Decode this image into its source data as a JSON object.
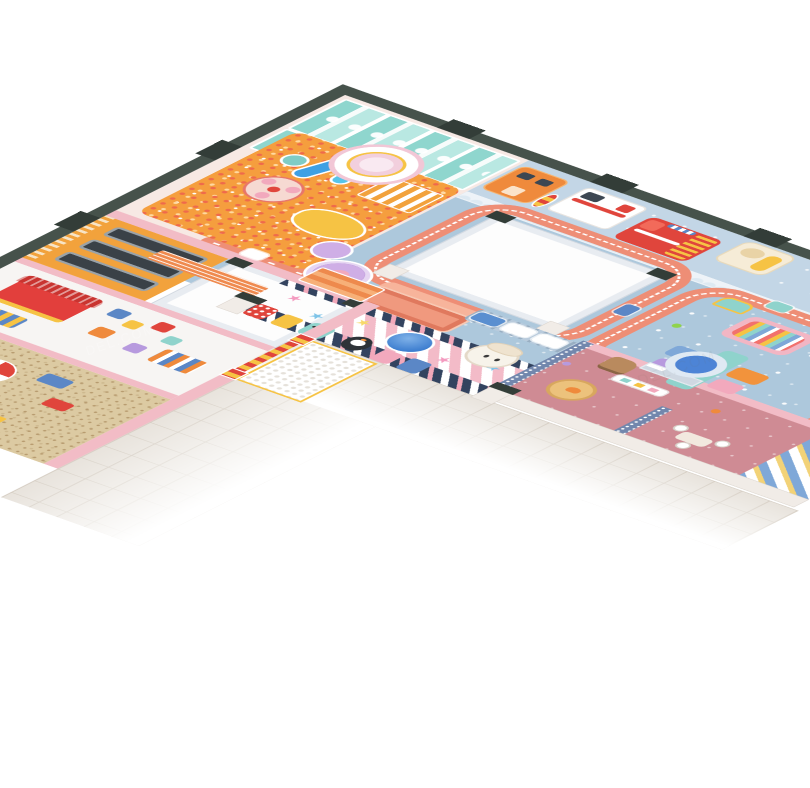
{
  "scene": {
    "description": "Isometric 3D render of an L-shaped indoor kids playground floor plan on a white background",
    "view": "isometric cutaway, outer corner at top, wings running to lower-left and lower-right",
    "background": "#ffffff"
  },
  "watermark": {
    "left_text": "DEL.COM",
    "right_text": "DEL.COM"
  },
  "icons": {
    "star": "★",
    "ball": "●"
  },
  "palette": {
    "wall_dark": "#46524b",
    "wall_cap": "#333d38",
    "floor_blue": "#adc8dc",
    "floor_blue_light": "#c3d6e6",
    "floor_hall": "#f7e9e4",
    "ballpit": "#f59e3e",
    "ball_red": "#ef6a4b",
    "sand": "#dccaa2",
    "stripe_pink": "#f3bbc8",
    "stripe_navy": "#33435f",
    "road": "#ee8e76",
    "apron": "#e8e3dc",
    "orange": "#f2a23c",
    "orange_deep": "#ef8a3c",
    "yellow": "#f6c344",
    "red": "#e0453c",
    "teal": "#8fd6ce",
    "slide_blue": "#3fa0e4",
    "pink_wall": "#f2bcc6",
    "rose": "#cf8b94",
    "partition": "#7287ad",
    "lavender": "#cfaee6",
    "pool": "#4d84d6",
    "stage": "#f0997e",
    "stage_light": "#f7b49b"
  },
  "zones": [
    {
      "name": "ball-pit-hall",
      "feature": "orange ball pit with central dome tower, rainbow stairs, carousel and teal climbing structure with blue slides"
    },
    {
      "name": "trampoline-room",
      "feature": "orange trampoline frame with three dark beds and slatted wall"
    },
    {
      "name": "building-blocks-room",
      "feature": "white floor, red-roof playhouse, foam blocks"
    },
    {
      "name": "sand-pit-room",
      "feature": "sand floor, umbrella table, pink playhouse, orange climbing wall"
    },
    {
      "name": "vehicle-corridor",
      "feature": "orange bus, ambulance, rainbow arch, fire truck, bear slide"
    },
    {
      "name": "race-track-hall",
      "feature": "salmon road loops with toy cars around two white roof voids, stage, UFO carousel, train"
    },
    {
      "name": "toddler-zone",
      "feature": "candy-stripe floor, star pillows, climbing dome, penguin face wall"
    },
    {
      "name": "role-play-room",
      "feature": "rose floor, window, clothes rack, round rug, ball pool"
    },
    {
      "name": "entrance-gate",
      "feature": "red-yellow striped pillars with honeycomb mat"
    },
    {
      "name": "outdoor-apron",
      "feature": "gray tiled walkway fading to white"
    }
  ],
  "objects": [
    {
      "name": "ambulance"
    },
    {
      "name": "fire-truck"
    },
    {
      "name": "orange-bus"
    },
    {
      "name": "bear-slide"
    },
    {
      "name": "rainbow-arch"
    },
    {
      "name": "train"
    },
    {
      "name": "ufo-carousel"
    },
    {
      "name": "mushroom-figure"
    },
    {
      "name": "stage"
    },
    {
      "name": "spinner-roller"
    },
    {
      "name": "soft-block-set"
    },
    {
      "name": "rocking-horse"
    },
    {
      "name": "ball-pool"
    },
    {
      "name": "climbing-dome"
    },
    {
      "name": "carousel"
    },
    {
      "name": "dome-tower"
    },
    {
      "name": "trampolines"
    },
    {
      "name": "umbrella-table"
    },
    {
      "name": "red-roof-playhouse"
    },
    {
      "name": "pink-playhouse"
    }
  ]
}
